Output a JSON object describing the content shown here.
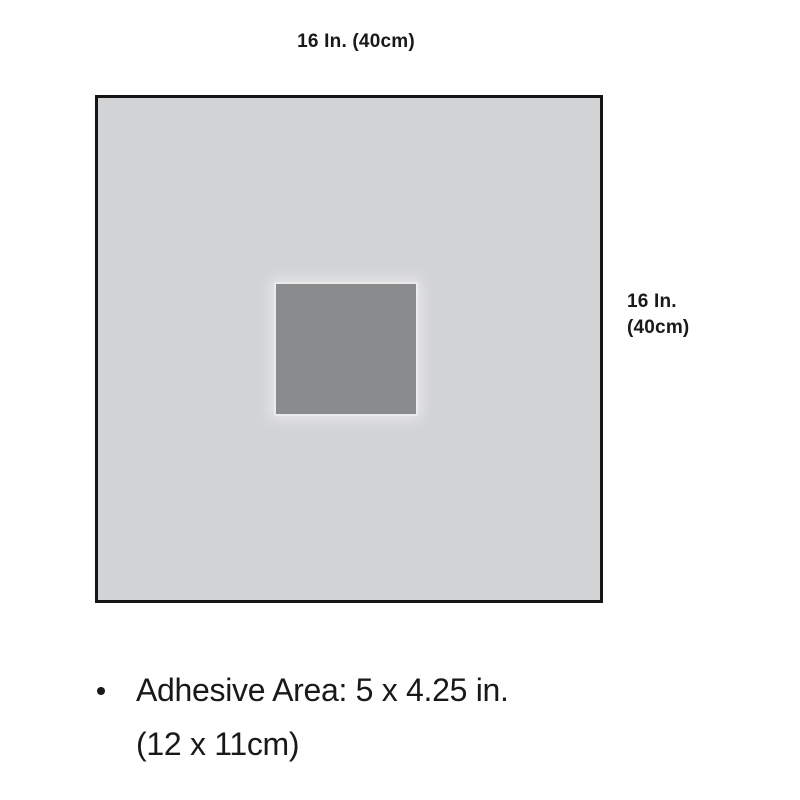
{
  "diagram": {
    "top_dimension_label": "16 In. (40cm)",
    "side_dimension_line1": "16 In.",
    "side_dimension_line2": "(40cm)",
    "drape_shape": "square",
    "adhesive_patch": "centered-rectangle",
    "colors": {
      "background": "#ffffff",
      "drape_fill": "#d2d3d5",
      "drape_border": "#151515",
      "adhesive_fill": "#8a8b8d",
      "text": "#191919"
    }
  },
  "notes": {
    "bullet_line1": "Adhesive Area: 5 x 4.25 in.",
    "bullet_line2": "(12 x 11cm)"
  }
}
